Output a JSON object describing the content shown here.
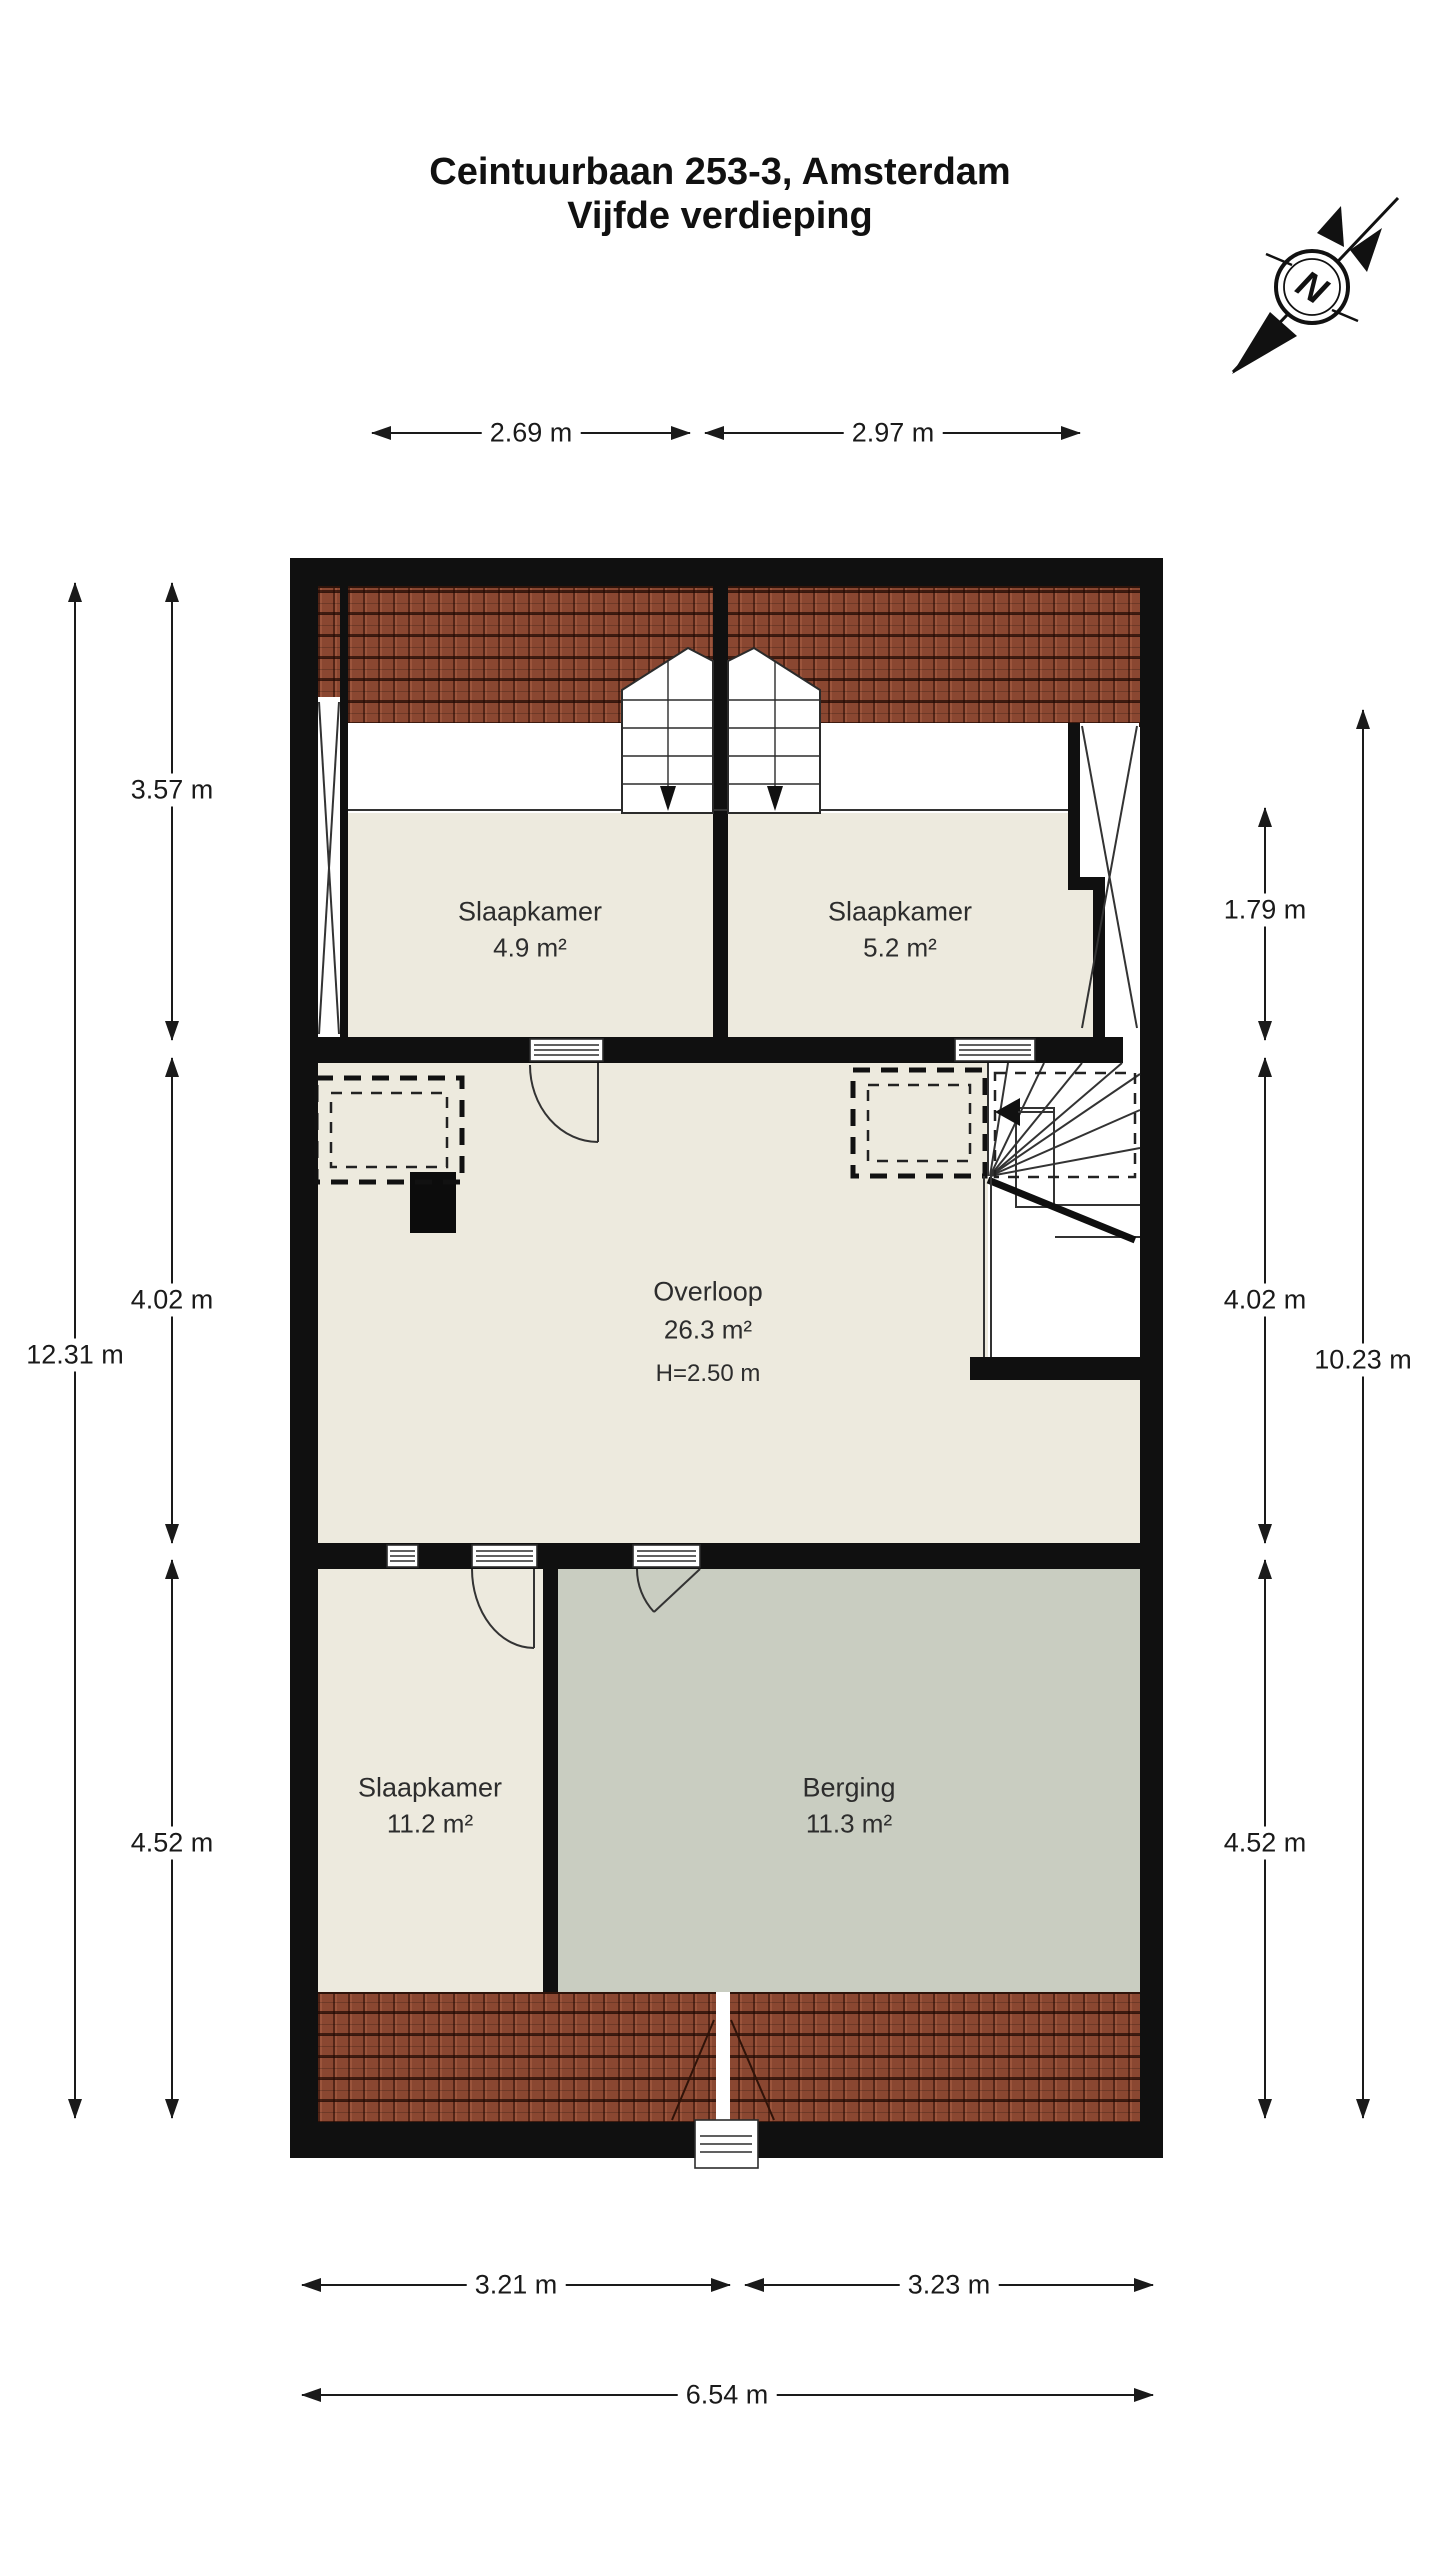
{
  "page": {
    "title_line1": "Ceintuurbaan 253-3, Amsterdam",
    "title_line2": "Vijfde verdieping"
  },
  "compass": {
    "label": "N"
  },
  "rooms": {
    "bedroom_tl": {
      "name": "Slaapkamer",
      "area": "4.9 m²"
    },
    "bedroom_tr": {
      "name": "Slaapkamer",
      "area": "5.2 m²"
    },
    "landing": {
      "name": "Overloop",
      "area": "26.3 m²",
      "ceiling": "H=2.50 m"
    },
    "bedroom_b": {
      "name": "Slaapkamer",
      "area": "11.2 m²"
    },
    "storage": {
      "name": "Berging",
      "area": "11.3 m²"
    }
  },
  "dims": {
    "top_left": "2.69 m",
    "top_right": "2.97 m",
    "left_1": "3.57 m",
    "left_2": "4.02 m",
    "left_3": "4.52 m",
    "left_total": "12.31 m",
    "right_1": "1.79 m",
    "right_2": "4.02 m",
    "right_3": "4.52 m",
    "right_total": "10.23 m",
    "bottom_left": "3.21 m",
    "bottom_right": "3.23 m",
    "bottom_total": "6.54 m"
  },
  "colors": {
    "wall": "#101010",
    "floor": "#EDEADE",
    "storage_floor": "#C9CDC1",
    "roof_tile": "#8A4731",
    "line": "#333333"
  }
}
